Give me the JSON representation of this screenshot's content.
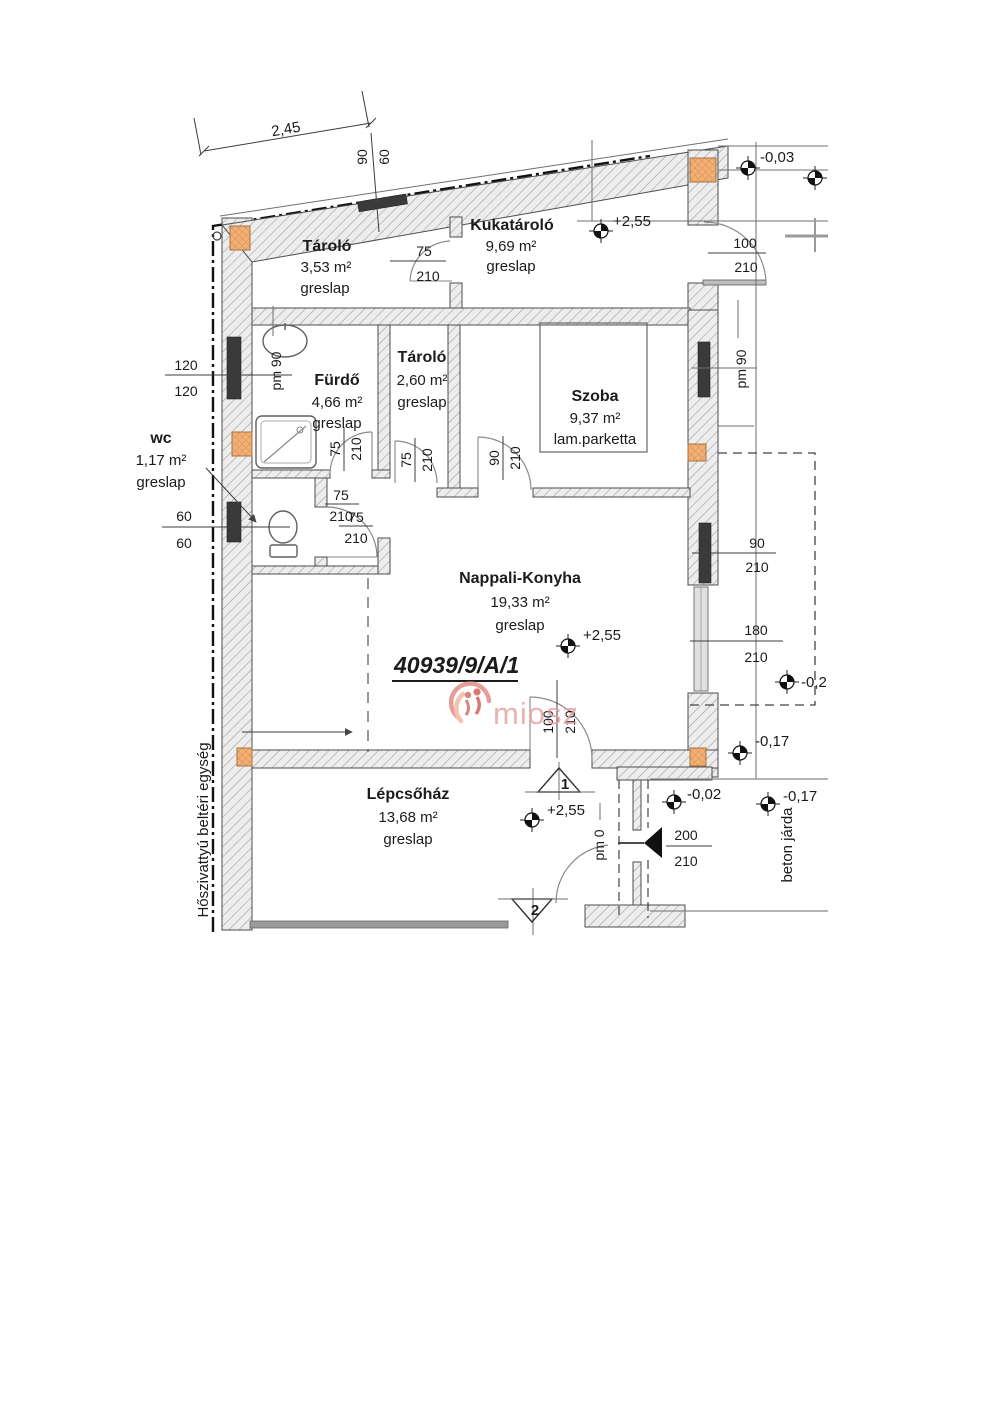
{
  "parcel_number": "40939/9/A/1",
  "watermark_text": "miosz",
  "overall_dimension": "2,45",
  "rooms": [
    {
      "name": "Tároló",
      "area": "3,53 m²",
      "floor": "greslap"
    },
    {
      "name": "Kukatároló",
      "area": "9,69 m²",
      "floor": "greslap"
    },
    {
      "name": "Fürdő",
      "area": "4,66 m²",
      "floor": "greslap"
    },
    {
      "name": "Tároló",
      "area": "2,60 m²",
      "floor": "greslap"
    },
    {
      "name": "Szoba",
      "area": "9,37 m²",
      "floor": "lam.parketta"
    },
    {
      "name": "wc",
      "area": "1,17 m²",
      "floor": "greslap"
    },
    {
      "name": "Nappali-Konyha",
      "area": "19,33 m²",
      "floor": "greslap"
    },
    {
      "name": "Lépcsőház",
      "area": "13,68 m²",
      "floor": "greslap"
    }
  ],
  "dims": {
    "top_window": {
      "a": "90",
      "b": "60"
    },
    "storage_door": {
      "a": "75",
      "b": "210"
    },
    "kuka_door": {
      "a": "100",
      "b": "210"
    },
    "window_120": {
      "a": "120",
      "b": "120"
    },
    "window_60": {
      "a": "60",
      "b": "60"
    },
    "bath_door": {
      "a": "75",
      "b": "210"
    },
    "storage2_door": {
      "a": "75",
      "b": "210"
    },
    "szoba_door": {
      "a": "90",
      "b": "210"
    },
    "wc_door": {
      "a": "75",
      "b": "210"
    },
    "hall_door": {
      "a": "75",
      "b": "210"
    },
    "right_window": {
      "a": "90",
      "b": "210"
    },
    "terrace_door": {
      "a": "180",
      "b": "210"
    },
    "nappali_door": {
      "a": "100",
      "b": "210"
    },
    "entrance_door": {
      "a": "200",
      "b": "210"
    }
  },
  "parapets": {
    "bath": "pm 90",
    "bedroom": "pm 90",
    "entrance": "pm 0"
  },
  "elevations": {
    "kuka_level": "+2,55",
    "street_top": "-0,03",
    "nappali_level": "+2,55",
    "terrace": "-0,2",
    "walkway_upper": "-0,17",
    "stair_level": "+2,55",
    "entrance_porch": "-0,02",
    "walkway_lower": "-0,17"
  },
  "sections": {
    "s1": "1",
    "s2": "2"
  },
  "notes": {
    "heat_pump": "Hőszivattyú beltéri egység",
    "walkway": "beton járda"
  },
  "colors": {
    "column_fill": "#f2b077",
    "watermark_pink": "#e5a0a0",
    "wall_hatch": "#9a9a9a"
  }
}
